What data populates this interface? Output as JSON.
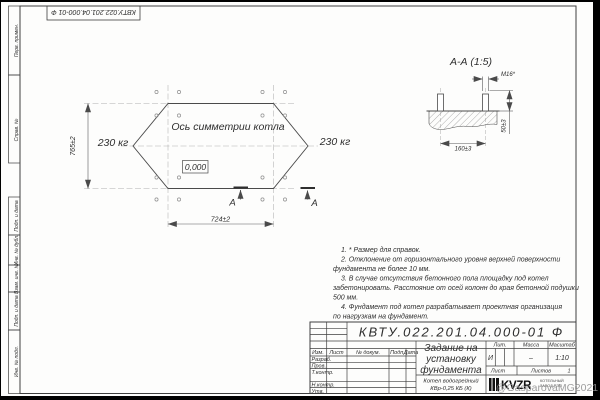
{
  "doc": {
    "number_top": "КВТУ.022.201.04.000-01 Ф",
    "number_main": "КВТУ.022.201.04.000-01 Ф"
  },
  "side_stamps": {
    "perv": "Перв. примен.",
    "sprav": "Справ. №",
    "podp1": "Подп. и дата",
    "inv_dubl": "Инв. № дубл.",
    "vzam": "Взам. инв. №",
    "podp2": "Подп. и дата",
    "inv_podl": "Инв. № подл."
  },
  "plan": {
    "axis_label": "Ось симметрии котла",
    "weight_left": "230 кг",
    "weight_right": "230 кг",
    "elevation": "0,000",
    "dim_width": "724±2",
    "dim_height": "765±2",
    "section_letter_left": "А",
    "section_letter_right": "А"
  },
  "section": {
    "title": "А-А (1:5)",
    "bolt_label": "М16*",
    "dim_height": "50±3",
    "dim_spacing": "160±3"
  },
  "notes": [
    "1. * Размер для справок.",
    "2. Отклонение от горизонтального уровня верхней поверхности",
    "фундамента не более 10 мм.",
    "3. В случае отсутствия бетонного пола площадку под котел",
    "забетонировать. Расстояние от осей колонн до края бетонной подушки",
    "500 мм.",
    "4. Фундамент под котел разрабатывает проектная организация",
    "по нагрузкам на фундамент."
  ],
  "titleblock": {
    "title_line1": "Задание на",
    "title_line2": "установку",
    "title_line3": "фундамента",
    "product_line1": "Котел водогрейный",
    "product_line2": "КВр-0,25 КБ (К)",
    "col_izm": "Изм.",
    "col_list": "Лист",
    "col_docnum": "№ докум.",
    "col_podp": "Подп.",
    "col_data": "Дата",
    "row_razrab": "Разраб.",
    "row_prov": "Пров.",
    "row_tkontr": "Т.контр.",
    "row_nkontr": "Н.контр.",
    "row_utv": "Утв.",
    "lit_header": "Лит.",
    "lit_value": "И",
    "mass_header": "Масса",
    "mass_value": "–",
    "scale_header": "Масштаб",
    "scale_value": "1:10",
    "sheet_label": "Лист",
    "sheets_label": "Листов",
    "sheets_value": "1",
    "logo_text": "KVZR",
    "logo_sub1": "КОТЕЛЬНЫЙ",
    "logo_sub2": "ЗАВОД РЭП"
  },
  "watermark": "@GasparovaMG2021",
  "colors": {
    "line": "#3f3f3f",
    "thin": "#5a5a5a",
    "center": "#b0b0b0"
  }
}
